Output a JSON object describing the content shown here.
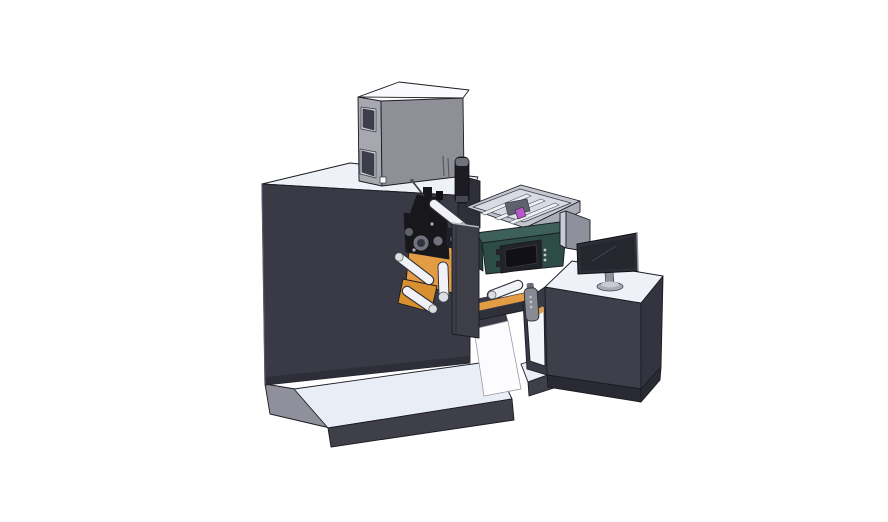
{
  "canvas": {
    "width": "888",
    "height": "522"
  },
  "scene": {
    "type": "3d-cad-assembly-render",
    "subject": "Label printing machine line: main press cabinet with electrical box on top, web unwind roller mechanism with orange mounting plates, coding printer unit with control screen, open collection tray, white label web, and operator desk with monitor, guard panel and hand pendant",
    "background": "#ffffff"
  },
  "components": [
    {
      "id": "base-platform",
      "label": "machine base platform"
    },
    {
      "id": "machine-body",
      "label": "main machine cabinet"
    },
    {
      "id": "electrical-cabinet",
      "label": "electrical cabinet with inspection windows"
    },
    {
      "id": "black-cylinder",
      "label": "cylinder fitting beside cabinet"
    },
    {
      "id": "unwind-mechanism",
      "label": "roller mechanism with orange plates"
    },
    {
      "id": "front-door-panel",
      "label": "front access panel"
    },
    {
      "id": "collection-tray",
      "label": "open tray with guide rails"
    },
    {
      "id": "printer-unit",
      "label": "teal coding printer with control screen"
    },
    {
      "id": "paper-web",
      "label": "white label web"
    },
    {
      "id": "conveyor-beam",
      "label": "transfer beam with orange belt"
    },
    {
      "id": "hand-pendant",
      "label": "hand-held control pendant"
    },
    {
      "id": "operator-desk",
      "label": "operator desk with open shelf"
    },
    {
      "id": "monitor",
      "label": "desktop monitor"
    },
    {
      "id": "divider-panel",
      "label": "side guard panel"
    }
  ],
  "colors": {
    "background": "#ffffff",
    "body_dark": "#3a3a46",
    "body_shadow": "#2e2e38",
    "surface_light": "#eef1f8",
    "platform_top": "#e9edf6",
    "platform_front": "#3f3f4a",
    "platform_side": "#8f909c",
    "cabinet_front": "#8f8f98",
    "cabinet_side": "#a7a7b0",
    "cabinet_top": "#fafafc",
    "window_glass": "#3e3e4a",
    "window_frame": "#c9cad2",
    "frame_block": "#2f2f3a",
    "cylinder_black": "#1c1c22",
    "cylinder_cap": "#72727c",
    "cylinder_base": "#46464e",
    "tray_rim": "#c3c6d0",
    "tray_interior": "#d8dbe3",
    "tray_rail": "#f0f2f7",
    "tray_side": "#a9adb8",
    "tray_mech": "#5f626c",
    "accent_purple": "#bb55cc",
    "printer_teal": "#2e4c46",
    "printer_teal_top": "#3d615a",
    "printer_teal_side": "#24403b",
    "screen_frame": "#23232b",
    "screen_glass": "#101016",
    "divider_panel": "#8e909c",
    "divider_edge": "#c9ccd6",
    "monitor_body": "#2e2e38",
    "monitor_screen": "#26262f",
    "monitor_stand": "#8f929c",
    "monitor_base": "#a8abb6",
    "desk_front": "#3f3f4b",
    "desk_side": "#343440",
    "desk_base": "#2a2a34",
    "shelf_interior": "#f3f5fa",
    "accent_orange": "#e49c44",
    "accent_orange_dark": "#d8902f",
    "roller_white": "#f1f2f7",
    "roller_cap": "#dcdee6",
    "web_white": "#fcfcff",
    "beam_dark": "#30303a",
    "pendant_gray": "#878a93",
    "pendant_clip": "#6a6d76",
    "pendant_dot": "#c6c8d0",
    "mech_black": "#17171c",
    "mech_gray": "#6f727c",
    "bracket_dark": "#20202a",
    "door_panel": "#3e3e49"
  }
}
